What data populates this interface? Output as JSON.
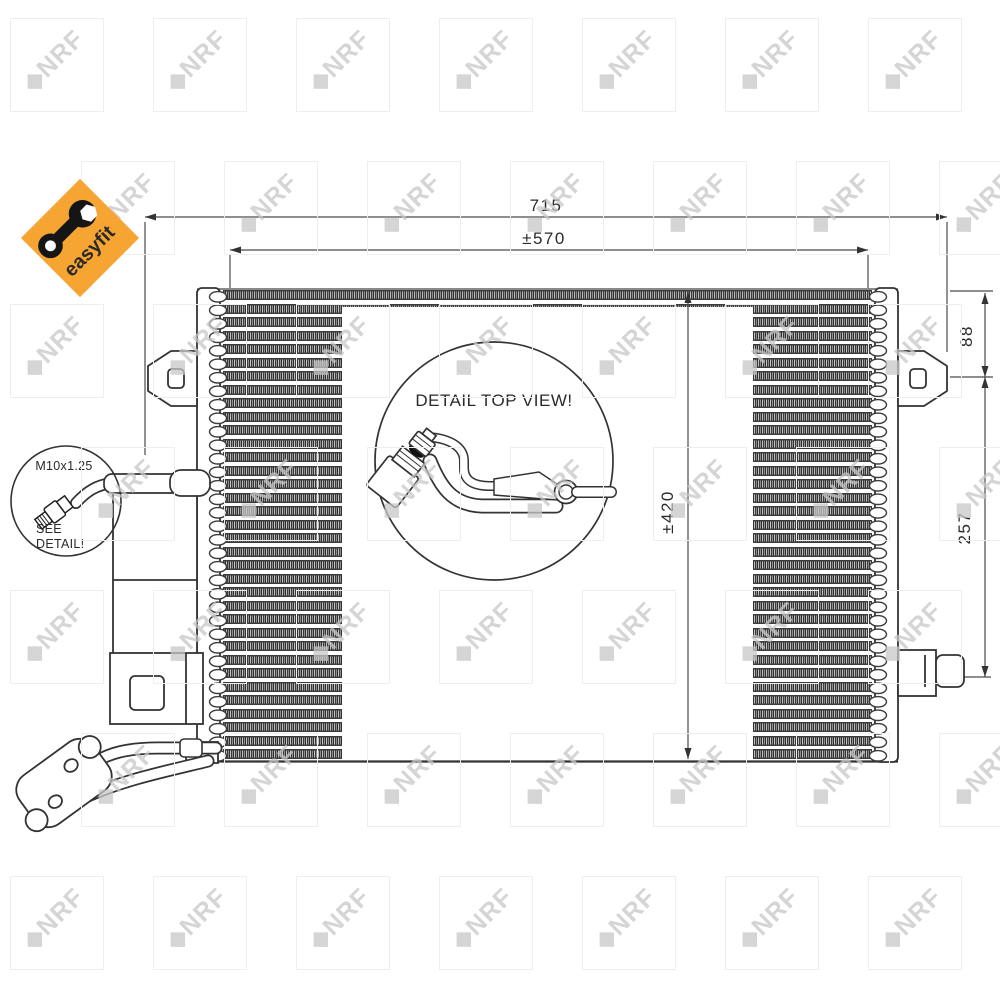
{
  "branding": {
    "badge_text": "easyfit",
    "badge_color": "#F6A432",
    "badge_text_color": "#4B521D",
    "watermark_text": "◆NRF",
    "watermark_color": "#C7C7C7"
  },
  "dimensions": {
    "width_total": "715",
    "width_ports": "±570",
    "height_bracket": "88",
    "height_core": "±420",
    "height_connector": "257"
  },
  "callouts": {
    "top_view_label": "DETAIL TOP VIEW!",
    "thread_label": "M10x1.25",
    "see_detail_line1": "SEE",
    "see_detail_line2": "DETAIL!"
  },
  "drawing": {
    "line_color": "#333333",
    "fin_row_count": 35,
    "watermark": {
      "cols": 7,
      "rows": 7,
      "spacing": 143
    }
  }
}
